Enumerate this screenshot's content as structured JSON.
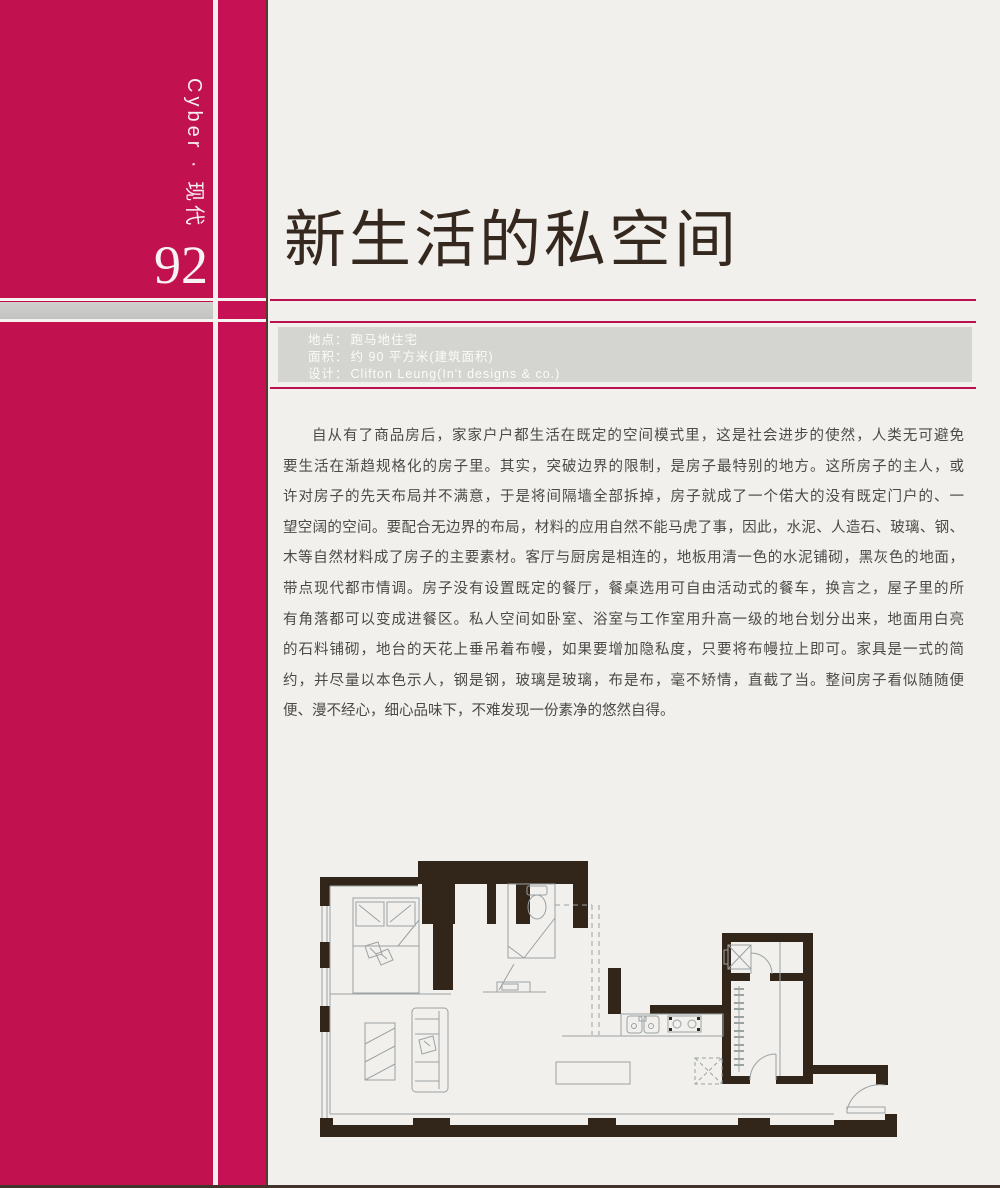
{
  "colors": {
    "accent_block": "#c2114f",
    "accent_strip": "#c61254",
    "rule_crimson": "#bc1150",
    "info_box_bg": "#d4d4d1",
    "title_color": "#35291f",
    "plan_wall_color": "#32251a",
    "page_background": "#f2f0ed"
  },
  "sidebar": {
    "vertical_label": "Cyber · 现代",
    "page_number": "92"
  },
  "header": {
    "title": "新生活的私空间"
  },
  "info_box": {
    "rows": [
      {
        "label": "地点：",
        "value": "跑马地住宅"
      },
      {
        "label": "面积：",
        "value": "约 90 平方米(建筑面积)"
      },
      {
        "label": "设计：",
        "value": "Clifton Leung(In't designs & co.)"
      }
    ]
  },
  "article": {
    "lines": [
      "自从有了商品房后，家家户户都生活在既定的空间模式里，这是社会进步的使然，人类无可避免",
      "要生活在渐趋规格化的房子里。其实，突破边界的限制，是房子最特别的地方。这所房子的主人，或",
      "许对房子的先天布局并不满意，于是将间隔墙全部拆掉，房子就成了一个偌大的没有既定门户的、一",
      "望空阔的空间。要配合无边界的布局，材料的应用自然不能马虎了事，因此，水泥、人造石、玻璃、钢、",
      "木等自然材料成了房子的主要素材。客厅与厨房是相连的，地板用清一色的水泥铺砌，黑灰色的地面，",
      "带点现代都市情调。房子没有设置既定的餐厅，餐桌选用可自由活动式的餐车，换言之，屋子里的所",
      "有角落都可以变成进餐区。私人空间如卧室、浴室与工作室用升高一级的地台划分出来，地面用白亮",
      "的石料铺砌，地台的天花上垂吊着布幔，如果要增加隐私度，只要将布幔拉上即可。家具是一式的简",
      "约，并尽量以本色示人，钢是钢，玻璃是玻璃，布是布，毫不矫情，直截了当。整间房子看似随随便",
      "便、漫不经心，细心品味下，不难发现一份素净的悠然自得。"
    ]
  }
}
